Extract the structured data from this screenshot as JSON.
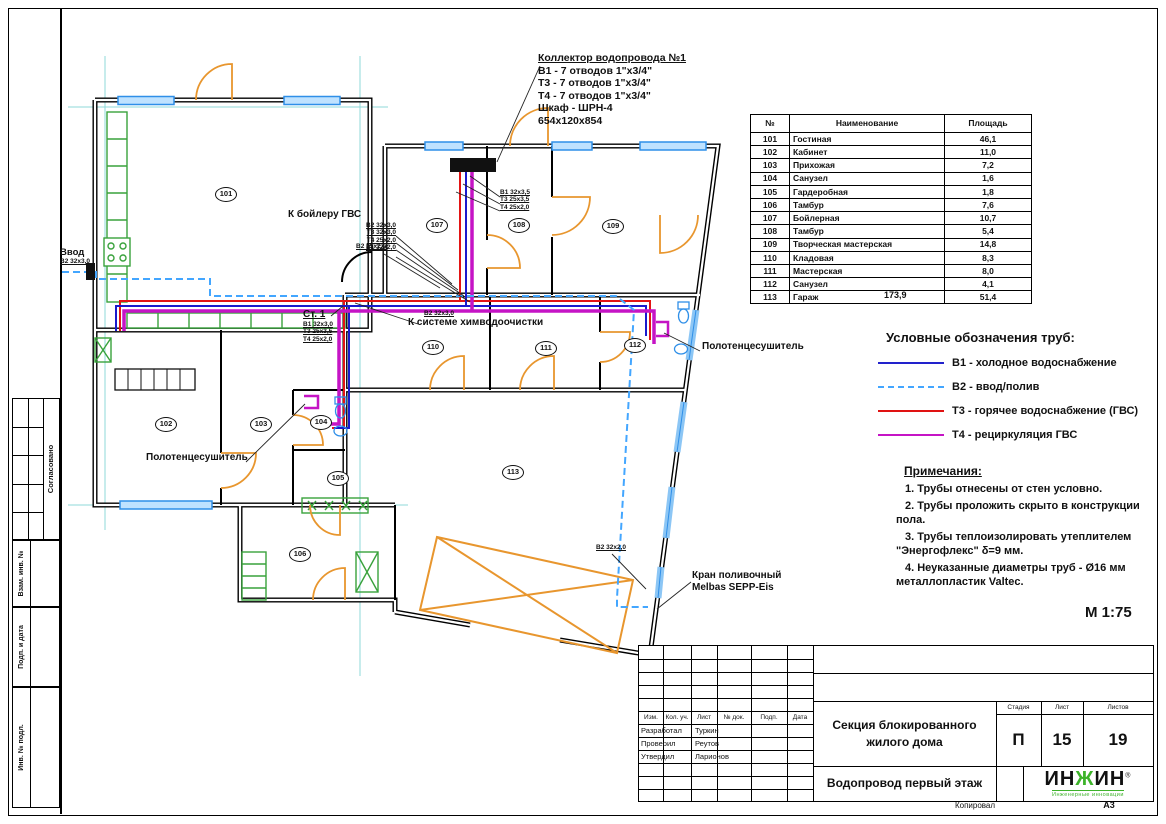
{
  "drawing": {
    "scale": "М 1:75",
    "format": "А3",
    "kopiroval": "Копировал"
  },
  "table": {
    "col_no": "№",
    "col_name": "Наименование",
    "col_area": "Площадь",
    "total": "173,9"
  },
  "rooms": [
    {
      "id": "101",
      "name": "Гостиная",
      "area": "46,1"
    },
    {
      "id": "102",
      "name": "Кабинет",
      "area": "11,0"
    },
    {
      "id": "103",
      "name": "Прихожая",
      "area": "7,2"
    },
    {
      "id": "104",
      "name": "Санузел",
      "area": "1,6"
    },
    {
      "id": "105",
      "name": "Гардеробная",
      "area": "1,8"
    },
    {
      "id": "106",
      "name": "Тамбур",
      "area": "7,6"
    },
    {
      "id": "107",
      "name": "Бойлерная",
      "area": "10,7"
    },
    {
      "id": "108",
      "name": "Тамбур",
      "area": "5,4"
    },
    {
      "id": "109",
      "name": "Творческая мастерская",
      "area": "14,8"
    },
    {
      "id": "110",
      "name": "Кладовая",
      "area": "8,3"
    },
    {
      "id": "111",
      "name": "Мастерская",
      "area": "8,0"
    },
    {
      "id": "112",
      "name": "Санузел",
      "area": "4,1"
    },
    {
      "id": "113",
      "name": "Гараж",
      "area": "51,4"
    }
  ],
  "legend": {
    "title": "Условные обозначения труб:",
    "items": [
      {
        "label": "В1 - холодное водоснабжение",
        "color": "#2222cc",
        "style": "solid"
      },
      {
        "label": "В2 - ввод/полив",
        "color": "#43a6ff",
        "style": "dashed"
      },
      {
        "label": "Т3 - горячее водоснабжение (ГВС)",
        "color": "#e01212",
        "style": "solid"
      },
      {
        "label": "Т4 - рециркуляция ГВС",
        "color": "#c514c5",
        "style": "solid"
      }
    ]
  },
  "notes": {
    "title": "Примечания:",
    "items": [
      "1. Трубы отнесены от стен условно.",
      "2. Трубы проложить скрыто в конструкции пола.",
      "3. Трубы теплоизолировать утеплителем \"Энергофлекс\" δ=9 мм.",
      "4. Неуказанные диаметры труб - Ø16 мм металлопластик Valtec."
    ]
  },
  "annotations": {
    "collector": {
      "title": "Коллектор водопровода №1",
      "lines": [
        "В1 - 7 отводов 1\"х3/4\"",
        "Т3 - 7 отводов 1\"х3/4\"",
        "Т4 - 7 отводов 1\"х3/4\"",
        "Шкаф - ШРН-4",
        "654х120х854"
      ]
    },
    "boiler": {
      "title": "К бойлеру ГВС",
      "sizes": [
        "В2 32х3,0",
        "Т3 32х3,0",
        "Т4 25х2,0",
        "В1 32х2,0"
      ]
    },
    "vvod": {
      "title": "Ввод",
      "size": "В2 32х3,0"
    },
    "st1": {
      "title": "Ст. 1",
      "sizes": [
        "В1 32х3,0",
        "Т3 25х3,5",
        "Т4 25х2,0"
      ]
    },
    "chem": {
      "size": "В2 32х3,0",
      "title": "К системе химводоочистки"
    },
    "b2_mid": "В2 25х2,0",
    "collector_sizes": [
      "В1 32х3,5",
      "Т3 25х3,5",
      "Т4 25х2,0"
    ],
    "towel_right": "Полотенцесушитель",
    "towel_left": "Полотенцесушитель",
    "garage_b2": "В2 32х2,0",
    "kran_line1": "Кран поливочный",
    "kran_line2": "Melbas SEPP-Eis"
  },
  "titleblock": {
    "project": "Секция блокированного жилого дома",
    "sheet_title": "Водопровод первый этаж",
    "stage_label": "Стадия",
    "stage": "П",
    "sheet_label": "Лист",
    "sheet": "15",
    "sheets_label": "Листов",
    "sheets": "19",
    "cols": [
      "Изм.",
      "Кол. уч.",
      "Лист",
      "№ док.",
      "Подп.",
      "Дата"
    ],
    "roles": [
      {
        "role": "Разработал",
        "name": "Туркин"
      },
      {
        "role": "Проверил",
        "name": "Реутов"
      },
      {
        "role": "Утвердил",
        "name": "Ларионов"
      }
    ],
    "logo_left": "ИН",
    "logo_mid": "Ж",
    "logo_right": "ИН",
    "logo_reg": "®",
    "logo_sub": "Инженерные инновации"
  },
  "side_stamps": [
    "Согласовано",
    "Взам. инв. №",
    "Подп. и дата",
    "Инв. № подл."
  ]
}
